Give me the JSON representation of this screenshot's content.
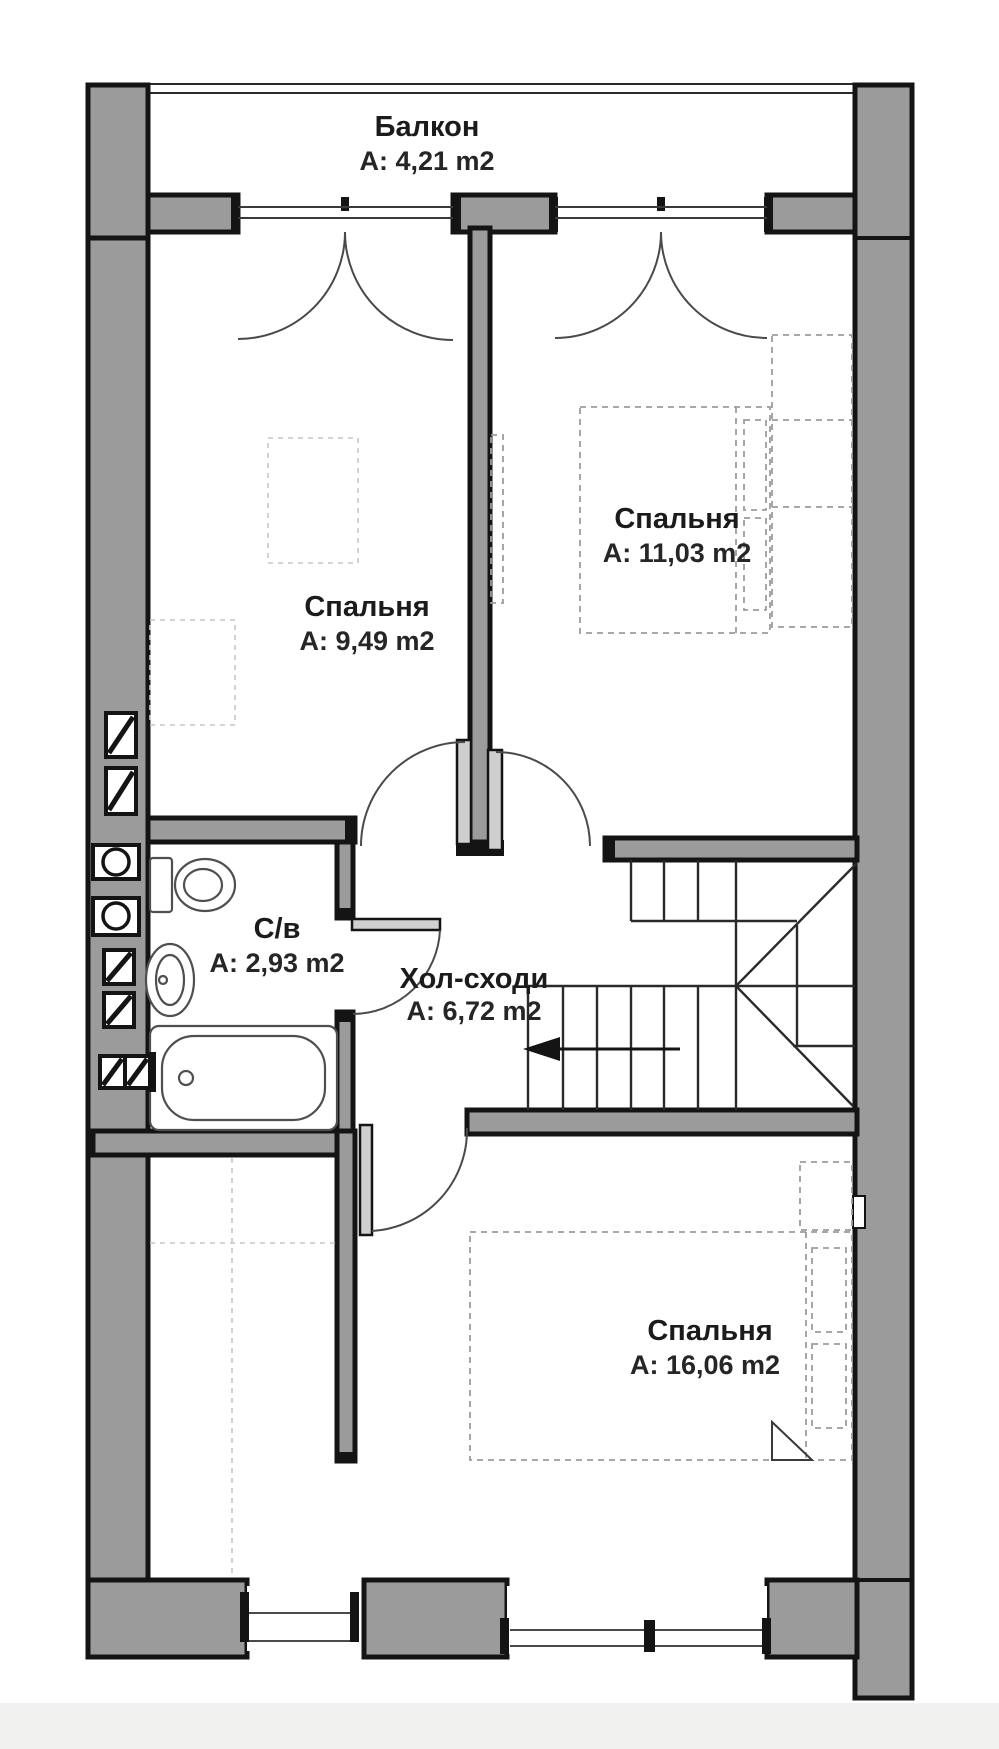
{
  "plan": {
    "rooms": [
      {
        "id": "balcony",
        "name": "Балкон",
        "area": "A: 4,21 m2"
      },
      {
        "id": "bedroom-left",
        "name": "Спальня",
        "area": "A: 9,49 m2"
      },
      {
        "id": "bedroom-right",
        "name": "Спальня",
        "area": "A: 11,03 m2"
      },
      {
        "id": "bathroom",
        "name": "С/в",
        "area": "A: 2,93 m2"
      },
      {
        "id": "hall-stairs",
        "name": "Хол-сходи",
        "area": "A: 6,72 m2"
      },
      {
        "id": "bedroom-big",
        "name": "Спальня",
        "area": "A: 16,06 m2"
      }
    ],
    "colors": {
      "wall_fill": "#9b9b9b",
      "wall_edge": "#141414",
      "line": "#2a2a2a",
      "background": "#ffffff",
      "text": "#1b1b1b"
    }
  }
}
